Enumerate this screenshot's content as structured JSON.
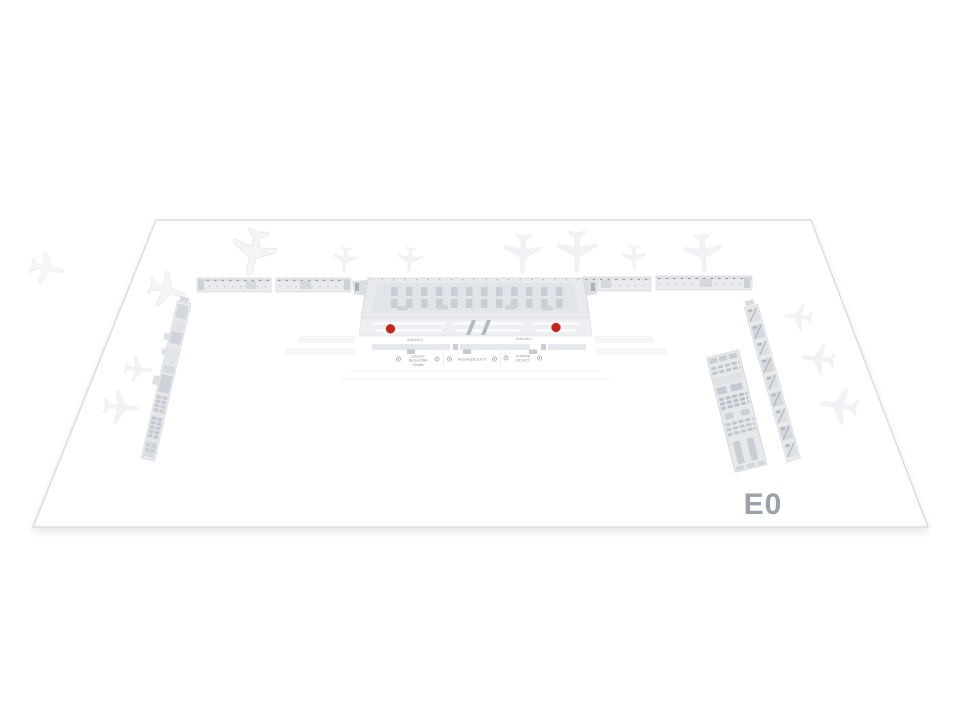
{
  "map": {
    "level_label": "E0",
    "level_label_color": "#9aa1a8",
    "marker_color": "#cb2318",
    "markers": [
      {
        "name": "poi-marker-left"
      },
      {
        "name": "poi-marker-right"
      }
    ],
    "terminal_labels": {
      "arrival_left": "Ankunft 2",
      "arrival_right": "Ankunft 1",
      "exit_left_line1": "Umland-",
      "exit_left_line2": "Busse/ÖBA",
      "exit_left_line3": "Shuttle",
      "exit_center": "Ausstieg B123/75",
      "exit_right_line1": "Ausstieg",
      "exit_right_line2": "B123/71"
    }
  }
}
